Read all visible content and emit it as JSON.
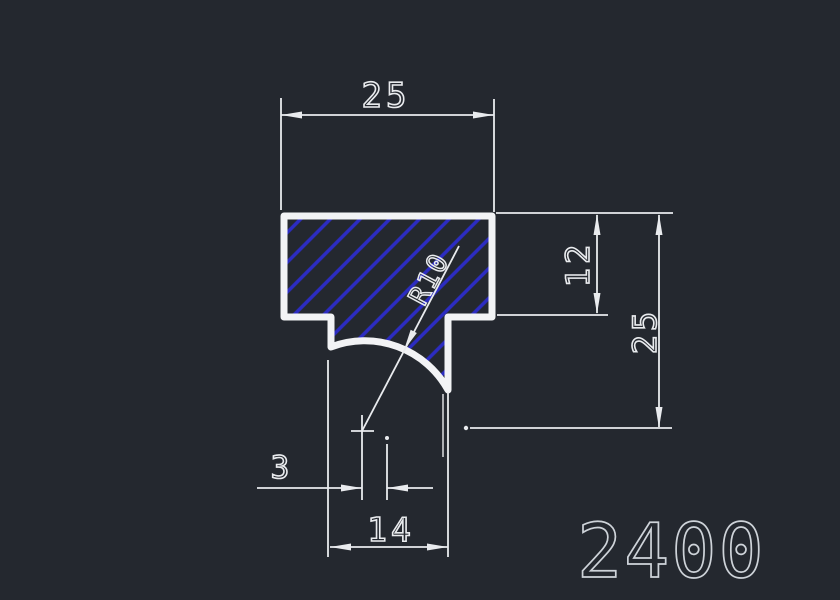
{
  "drawing": {
    "part_number": "2400",
    "dims": {
      "top_width": "25",
      "flange_height": "12",
      "overall_height": "25",
      "center_offset": "3",
      "stem_width": "14",
      "fillet_radius": "R10"
    }
  },
  "colors": {
    "bg": "#24282f",
    "line": "#f2f3f5",
    "dim": "#e9ebee",
    "hatch": "#2c2cc2",
    "pn": "#ced3d9"
  }
}
